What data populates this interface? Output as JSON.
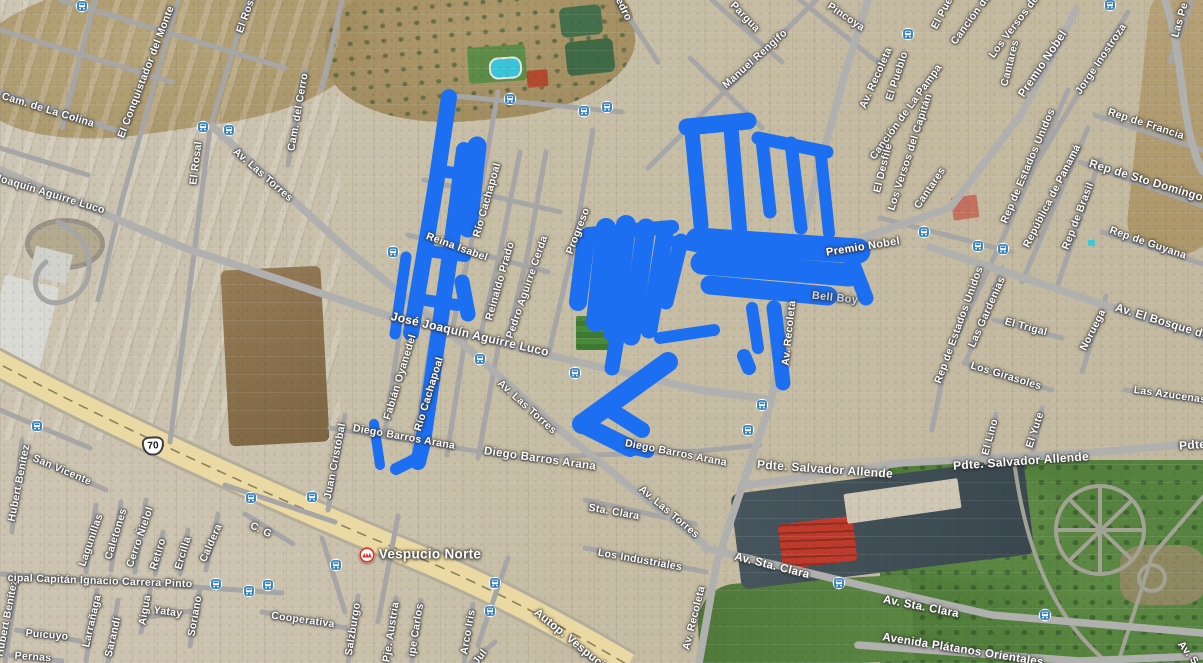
{
  "map": {
    "view_type": "satellite",
    "colors": {
      "track": "#1d6ff2",
      "road": "#a6a6a6",
      "avenue": "#b0b0ae",
      "highway_fill": "#ead9a2",
      "highway_casing": "#b3ad9c",
      "label": "#ffffff",
      "poi_label": "#c3d6ee",
      "transit_blue": "#2e7cb8",
      "metro_red": "#e03127"
    },
    "route_shield": {
      "text": "70",
      "x": 153,
      "y": 446
    },
    "metro": {
      "label": "Vespucio Norte",
      "icon_x": 367,
      "icon_y": 555,
      "label_x": 430,
      "label_y": 554
    },
    "street_labels": [
      {
        "t": "El Conquistador del Monte",
        "x": 146,
        "y": 72,
        "r": -69
      },
      {
        "t": "Cam. de La Colina",
        "x": 48,
        "y": 110,
        "r": 17
      },
      {
        "t": "Joaquín Aguirre Luco",
        "x": 50,
        "y": 194,
        "r": 17
      },
      {
        "t": "El Rosal",
        "x": 196,
        "y": 163,
        "r": -83
      },
      {
        "t": "El Rosal",
        "x": 247,
        "y": 12,
        "r": -70
      },
      {
        "t": "Av. Las Torres",
        "x": 263,
        "y": 175,
        "r": 41
      },
      {
        "t": "Cam. del Cerro",
        "x": 298,
        "y": 112,
        "r": -80
      },
      {
        "t": "Pedro",
        "x": 622,
        "y": 6,
        "r": 64
      },
      {
        "t": "Pargua",
        "x": 745,
        "y": 17,
        "r": 46
      },
      {
        "t": "Pincoya",
        "x": 846,
        "y": 17,
        "r": 34
      },
      {
        "t": "Manuel Rengifo",
        "x": 755,
        "y": 59,
        "r": -42
      },
      {
        "t": "Av. Recoleta",
        "x": 876,
        "y": 78,
        "r": -66
      },
      {
        "t": "El Pueblo",
        "x": 897,
        "y": 76,
        "r": -72
      },
      {
        "t": "El Pueblo",
        "x": 946,
        "y": 6,
        "r": -62
      },
      {
        "t": "Canción de La Pampa",
        "x": 906,
        "y": 112,
        "r": -54
      },
      {
        "t": "Canción de La Pampa",
        "x": 987,
        "y": -3,
        "r": -54
      },
      {
        "t": "Los Versos del Capitán",
        "x": 910,
        "y": 152,
        "r": -72
      },
      {
        "t": "Los Versos del Capitán",
        "x": 1028,
        "y": 8,
        "r": -53
      },
      {
        "t": "Cantares",
        "x": 1010,
        "y": 63,
        "r": -76
      },
      {
        "t": "Cantares",
        "x": 930,
        "y": 188,
        "r": -56
      },
      {
        "t": "El Desfile",
        "x": 883,
        "y": 168,
        "r": -76
      },
      {
        "t": "Premio Nobel",
        "x": 1043,
        "y": 64,
        "r": -56,
        "s": 11.5
      },
      {
        "t": "Jorge Inostroza",
        "x": 1101,
        "y": 59,
        "r": -56
      },
      {
        "t": "Las Pe",
        "x": 1180,
        "y": 20,
        "r": -74
      },
      {
        "t": "Rep de Francia",
        "x": 1146,
        "y": 124,
        "r": 18
      },
      {
        "t": "Rep de Sto Domingo",
        "x": 1146,
        "y": 181,
        "r": 17,
        "s": 11.5
      },
      {
        "t": "Rep de Estados Unidos",
        "x": 1028,
        "y": 166,
        "r": -67
      },
      {
        "t": "República de Panamá",
        "x": 1052,
        "y": 196,
        "r": -63
      },
      {
        "t": "Rep de Brasil",
        "x": 1078,
        "y": 216,
        "r": -69
      },
      {
        "t": "Rep de Guyana",
        "x": 1148,
        "y": 243,
        "r": 19
      },
      {
        "t": "Av. El Bosque de",
        "x": 1162,
        "y": 322,
        "r": 17,
        "s": 11.5
      },
      {
        "t": "Rep de Estados Unidos",
        "x": 959,
        "y": 325,
        "r": -70
      },
      {
        "t": "Las Gardenias",
        "x": 987,
        "y": 312,
        "r": -66
      },
      {
        "t": "El Trigal",
        "x": 1026,
        "y": 327,
        "r": 15
      },
      {
        "t": "Noruega",
        "x": 1093,
        "y": 330,
        "r": -63
      },
      {
        "t": "Los Girasoles",
        "x": 1006,
        "y": 376,
        "r": 17
      },
      {
        "t": "Las Azucenas",
        "x": 1170,
        "y": 395,
        "r": 8
      },
      {
        "t": "El Lino",
        "x": 990,
        "y": 437,
        "r": -75
      },
      {
        "t": "El Yute",
        "x": 1035,
        "y": 430,
        "r": -72
      },
      {
        "t": "Pdte. Salvador Allende",
        "x": 1247,
        "y": 441,
        "r": -4,
        "s": 12
      },
      {
        "t": "Río Cachapoal",
        "x": 487,
        "y": 200,
        "r": -74
      },
      {
        "t": "Reinaldo Prado",
        "x": 500,
        "y": 281,
        "r": -74
      },
      {
        "t": "Pedro Aguirre Cerda",
        "x": 527,
        "y": 287,
        "r": -71
      },
      {
        "t": "Progreso",
        "x": 578,
        "y": 231,
        "r": -69
      },
      {
        "t": "Reina Isabel",
        "x": 457,
        "y": 247,
        "r": 20
      },
      {
        "t": "José Joaquín Aguirre Luco",
        "x": 470,
        "y": 334,
        "r": 13,
        "s": 12
      },
      {
        "t": "Fabián Oyanedel",
        "x": 400,
        "y": 377,
        "r": -73
      },
      {
        "t": "Río Cachapoal",
        "x": 429,
        "y": 394,
        "r": -73
      },
      {
        "t": "Av. Las Torres",
        "x": 527,
        "y": 407,
        "r": 42
      },
      {
        "t": "Juan Cristóbal",
        "x": 335,
        "y": 461,
        "r": -79
      },
      {
        "t": "Diego Barros Arana",
        "x": 404,
        "y": 437,
        "r": 10
      },
      {
        "t": "Diego Barros Arana",
        "x": 540,
        "y": 459,
        "r": 8,
        "s": 11.5
      },
      {
        "t": "Diego Barros Arana",
        "x": 676,
        "y": 453,
        "r": 11
      },
      {
        "t": "Sta. Clara",
        "x": 614,
        "y": 512,
        "r": 10
      },
      {
        "t": "Los Industriales",
        "x": 640,
        "y": 560,
        "r": 10
      },
      {
        "t": "Av. Las Torres",
        "x": 669,
        "y": 512,
        "r": 40
      },
      {
        "t": "Pdte. Salvador Allende",
        "x": 825,
        "y": 469,
        "r": 4,
        "s": 12
      },
      {
        "t": "Pdte. Salvador Allende",
        "x": 1021,
        "y": 461,
        "r": -4,
        "s": 12
      },
      {
        "t": "Av. Recoleta",
        "x": 694,
        "y": 618,
        "r": -76
      },
      {
        "t": "Av. Recoleta",
        "x": 789,
        "y": 333,
        "r": -84
      },
      {
        "t": "Av. Sta. Clara",
        "x": 772,
        "y": 566,
        "r": 14,
        "s": 11.5
      },
      {
        "t": "Av. Sta. Clara",
        "x": 921,
        "y": 607,
        "r": 11,
        "s": 11.5
      },
      {
        "t": "Avenida Plátanos Orientales",
        "x": 963,
        "y": 650,
        "r": 9,
        "s": 11.5
      },
      {
        "t": "Av. S",
        "x": 1188,
        "y": 653,
        "r": 52
      },
      {
        "t": "Premio Nobel",
        "x": 863,
        "y": 247,
        "r": -9,
        "s": 11
      },
      {
        "t": "Bell Boy",
        "x": 835,
        "y": 298,
        "r": 6,
        "s": 11,
        "c": "#c3d6ee"
      },
      {
        "t": "Hubert Benítez",
        "x": 19,
        "y": 483,
        "r": -79
      },
      {
        "t": "Hubert Benítez",
        "x": 7,
        "y": 618,
        "r": -79
      },
      {
        "t": "San Vicente",
        "x": 62,
        "y": 470,
        "r": 23
      },
      {
        "t": "Lagunillas",
        "x": 91,
        "y": 540,
        "r": -71
      },
      {
        "t": "Caletones",
        "x": 116,
        "y": 534,
        "r": -73
      },
      {
        "t": "Cerro Ñielol",
        "x": 140,
        "y": 537,
        "r": -71
      },
      {
        "t": "Retiro",
        "x": 158,
        "y": 554,
        "r": -73
      },
      {
        "t": "Ercilla",
        "x": 183,
        "y": 553,
        "r": -73
      },
      {
        "t": "Caldera",
        "x": 211,
        "y": 543,
        "r": -66
      },
      {
        "t": "C. G",
        "x": 261,
        "y": 530,
        "r": 26
      },
      {
        "t": "cipal Capitán Ignacio Carrera Pinto",
        "x": 100,
        "y": 581,
        "r": 2
      },
      {
        "t": "Larrañaga",
        "x": 92,
        "y": 621,
        "r": -77
      },
      {
        "t": "Sarandí",
        "x": 113,
        "y": 637,
        "r": -77
      },
      {
        "t": "Aigua",
        "x": 145,
        "y": 610,
        "r": -80
      },
      {
        "t": "Yatay",
        "x": 168,
        "y": 612,
        "r": 7
      },
      {
        "t": "Soriano",
        "x": 195,
        "y": 616,
        "r": -80
      },
      {
        "t": "Puicuyo",
        "x": 47,
        "y": 635,
        "r": 5
      },
      {
        "t": "Pernas",
        "x": 33,
        "y": 657,
        "r": 4
      },
      {
        "t": "Cooperativa",
        "x": 303,
        "y": 620,
        "r": 8
      },
      {
        "t": "Salzburgo",
        "x": 353,
        "y": 629,
        "r": -81
      },
      {
        "t": "Pje. Austria",
        "x": 391,
        "y": 632,
        "r": -81
      },
      {
        "t": "ipe Carlos",
        "x": 416,
        "y": 630,
        "r": -81
      },
      {
        "t": "Arco Iris",
        "x": 468,
        "y": 632,
        "r": -80
      },
      {
        "t": "Jul",
        "x": 480,
        "y": 657,
        "r": -52
      },
      {
        "t": "Autop. Vespucio",
        "x": 572,
        "y": 641,
        "r": 39,
        "s": 11.5
      }
    ],
    "bus_stops": [
      [
        82,
        6
      ],
      [
        203,
        127
      ],
      [
        229,
        130
      ],
      [
        393,
        252
      ],
      [
        510,
        99
      ],
      [
        584,
        111
      ],
      [
        607,
        107
      ],
      [
        908,
        34
      ],
      [
        1110,
        5
      ],
      [
        37,
        426
      ],
      [
        480,
        359
      ],
      [
        575,
        373
      ],
      [
        762,
        405
      ],
      [
        748,
        430
      ],
      [
        924,
        232
      ],
      [
        978,
        246
      ],
      [
        1003,
        249
      ],
      [
        251,
        498
      ],
      [
        312,
        497
      ],
      [
        216,
        584
      ],
      [
        249,
        591
      ],
      [
        268,
        585
      ],
      [
        495,
        583
      ],
      [
        490,
        611
      ],
      [
        336,
        565
      ],
      [
        839,
        583
      ],
      [
        1045,
        615
      ]
    ],
    "roads": {
      "highway": "M-12,358 C100,418 260,492 400,550 C480,582 555,622 628,665",
      "ramp": "M58,222 C98,238 100,292 62,302 C36,308 26,278 46,262",
      "streets": [
        "M0,92 L125,133",
        "M178,0 L122,200 L98,300",
        "M248,0 L210,128",
        "M210,128 L170,442",
        "M305,70 L288,165",
        "M95,0 L62,128",
        "M60,0 L285,68",
        "M0,30 L172,82",
        "M0,148 L88,175",
        "M342,0 L322,88",
        "M445,95 L622,112",
        "M498,92 L470,250 L452,330",
        "M520,152 L500,252 L480,338",
        "M546,152 L528,252 L506,345",
        "M593,130 L575,240 L549,352",
        "M408,235 L548,272",
        "M424,180 L560,212",
        "M400,330 L385,432",
        "M432,335 L414,448",
        "M465,340 L447,455",
        "M498,348 L478,458",
        "M345,415 L328,510",
        "M330,428 L520,458 L700,451 L760,445",
        "M585,500 L695,524",
        "M585,548 L706,572",
        "M712,0 L782,62",
        "M800,0 L880,64",
        "M690,58 L762,128",
        "M648,168 L816,0",
        "M618,0 L658,62",
        "M1035,165 L1128,12",
        "M1095,115 L1203,150",
        "M1080,162 L1203,206",
        "M1102,232 L1203,264",
        "M1068,90 L1002,240 L946,360 L932,430",
        "M1088,128 L1022,282",
        "M1100,160 L1056,290",
        "M1002,268 L966,362",
        "M994,320 L1062,338",
        "M1106,296 L1082,372",
        "M964,363 L1052,390",
        "M1125,390 L1203,401",
        "M996,414 L986,462",
        "M1042,408 L1032,458",
        "M880,218 L1012,252",
        "M1192,0 L1170,62",
        "M20,452 L106,490",
        "M22,440 L12,532",
        "M18,575 L5,663",
        "M245,514 L293,544",
        "M0,574 L282,593",
        "M96,505 L86,572",
        "M121,502 L111,570",
        "M146,500 L135,572",
        "M163,532 L155,574",
        "M188,530 L180,574",
        "M218,514 L206,570",
        "M97,590 L86,661",
        "M118,600 L108,663",
        "M150,590 L141,632",
        "M200,588 L190,646",
        "M148,617 L190,611",
        "M16,630 L80,641",
        "M8,655 L62,661",
        "M262,612 L346,628",
        "M358,596 L348,663",
        "M396,598 L386,663",
        "M421,600 L412,661",
        "M473,604 L464,663",
        "M470,663 L495,642",
        "M398,516 L378,622",
        "M508,558 L478,645",
        "M322,538 L345,612",
        "M225,485 L335,522",
        "M0,410 L90,448"
      ],
      "avenues": [
        "M212,126 L350,252 L470,350 L560,430 L642,496 L706,546",
        "M0,170 L185,248 L395,318 L548,355 L700,390 L766,399",
        "M868,0 L843,80 L806,218 L788,310 L771,402 L747,472 L717,562 L699,663",
        "M790,262 L950,208 L1020,116 L1076,10",
        "M930,247 L1060,290 L1203,338",
        "M742,486 L900,463 L1100,452 L1203,443",
        "M705,548 L860,585 L992,615 L1203,633",
        "M858,645 L1080,661 L1203,656",
        "M1165,0 C1185,60 1180,130 1203,172"
      ],
      "park_paths": [
        "M1015,468 C1028,560 1058,622 1108,663",
        "M1203,497 L1152,556 L1118,663",
        "M1058,530 L1144,530",
        "M1100,488 L1100,572",
        "M1070,500 L1132,560",
        "M1070,560 L1132,500"
      ],
      "park_circles": [
        [
          1100,
          530,
          44
        ],
        [
          1152,
          578,
          13
        ]
      ]
    },
    "tracks": [
      {
        "d": "M449,97 L437,178 L423,262 L411,333",
        "w": 16
      },
      {
        "d": "M464,150 L451,248 L437,345 L423,442 L418,462",
        "w": 16
      },
      {
        "d": "M477,146 L468,228",
        "w": 19
      },
      {
        "d": "M440,171 L477,176",
        "w": 12
      },
      {
        "d": "M428,251 L465,256",
        "w": 12
      },
      {
        "d": "M418,299 L457,305",
        "w": 12
      },
      {
        "d": "M462,282 L468,314",
        "w": 15
      },
      {
        "d": "M406,257 L395,334",
        "w": 11
      },
      {
        "d": "M420,457 L396,469",
        "w": 12
      },
      {
        "d": "M374,424 L380,465",
        "w": 10
      },
      {
        "d": "M586,238 L578,302",
        "w": 18
      },
      {
        "d": "M606,228 L596,322",
        "w": 20
      },
      {
        "d": "M626,225 L613,332",
        "w": 20
      },
      {
        "d": "M646,228 L631,336",
        "w": 19
      },
      {
        "d": "M665,232 L649,330",
        "w": 17
      },
      {
        "d": "M681,241 L666,302",
        "w": 15
      },
      {
        "d": "M588,234 L672,227",
        "w": 14
      },
      {
        "d": "M618,332 L612,368",
        "w": 15
      },
      {
        "d": "M668,362 L582,424",
        "w": 20
      },
      {
        "d": "M582,424 L630,448",
        "w": 18
      },
      {
        "d": "M604,406 L642,430",
        "w": 16
      },
      {
        "d": "M630,448 L648,452",
        "w": 12
      },
      {
        "d": "M687,127 L748,121",
        "w": 17
      },
      {
        "d": "M692,132 L701,225",
        "w": 15
      },
      {
        "d": "M731,128 L740,235",
        "w": 15
      },
      {
        "d": "M762,140 L770,212",
        "w": 13
      },
      {
        "d": "M758,138 L827,152",
        "w": 13
      },
      {
        "d": "M791,143 L801,228",
        "w": 13
      },
      {
        "d": "M821,156 L829,233",
        "w": 12
      },
      {
        "d": "M698,240 L858,251",
        "w": 25
      },
      {
        "d": "M702,263 L849,275",
        "w": 23
      },
      {
        "d": "M710,285 L828,296",
        "w": 19
      },
      {
        "d": "M849,254 L866,298",
        "w": 15
      },
      {
        "d": "M774,308 L783,383",
        "w": 15
      },
      {
        "d": "M752,308 L758,348",
        "w": 12
      },
      {
        "d": "M700,246 L676,242",
        "w": 13
      },
      {
        "d": "M660,338 L714,330",
        "w": 12
      },
      {
        "d": "M744,356 L749,368",
        "w": 14
      }
    ]
  }
}
